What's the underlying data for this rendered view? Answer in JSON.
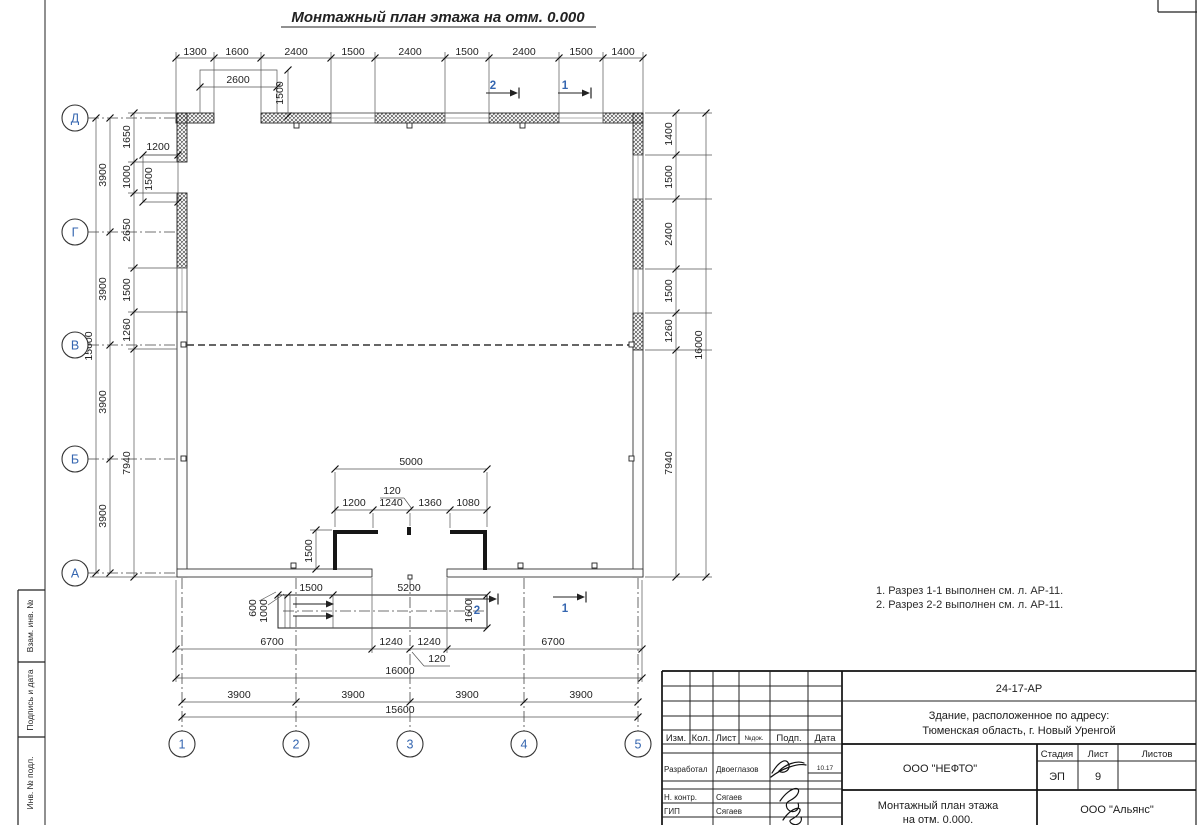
{
  "colors": {
    "axis_blue": "#3566b0",
    "ink": "#222222",
    "paper": "#ffffff"
  },
  "drawing": {
    "title": "Монтажный план этажа на отм. 0.000",
    "notes": {
      "line1": "1. Разрез 1-1 выполнен см. л. АР-11.",
      "line2": "2. Разрез 2-2 выполнен см. л. АР-11."
    }
  },
  "axis_bubbles": {
    "rows": [
      {
        "label": "Д",
        "cy": 118
      },
      {
        "label": "Г",
        "cy": 232
      },
      {
        "label": "В",
        "cy": 345
      },
      {
        "label": "Б",
        "cy": 459
      },
      {
        "label": "А",
        "cy": 573
      }
    ],
    "cols": [
      {
        "label": "1",
        "cx": 182
      },
      {
        "label": "2",
        "cx": 296
      },
      {
        "label": "3",
        "cx": 410
      },
      {
        "label": "4",
        "cx": 524
      },
      {
        "label": "5",
        "cx": 638
      }
    ]
  },
  "dimension_labels": [
    {
      "t": "1300",
      "x": 195,
      "y": 55,
      "r": 0
    },
    {
      "t": "1600",
      "x": 237,
      "y": 55,
      "r": 0
    },
    {
      "t": "2400",
      "x": 296,
      "y": 55,
      "r": 0
    },
    {
      "t": "1500",
      "x": 353,
      "y": 55,
      "r": 0
    },
    {
      "t": "2400",
      "x": 410,
      "y": 55,
      "r": 0
    },
    {
      "t": "1500",
      "x": 467,
      "y": 55,
      "r": 0
    },
    {
      "t": "2400",
      "x": 524,
      "y": 55,
      "r": 0
    },
    {
      "t": "1500",
      "x": 581,
      "y": 55,
      "r": 0
    },
    {
      "t": "1400",
      "x": 623,
      "y": 55,
      "r": 0
    },
    {
      "t": "2600",
      "x": 238,
      "y": 83,
      "r": 0
    },
    {
      "t": "1500",
      "x": 283,
      "y": 93,
      "r": 1
    },
    {
      "t": "1200",
      "x": 158,
      "y": 150,
      "r": 0
    },
    {
      "t": "1500",
      "x": 152,
      "y": 179,
      "r": 1
    },
    {
      "t": "1650",
      "x": 130,
      "y": 137,
      "r": 1
    },
    {
      "t": "1000",
      "x": 130,
      "y": 177,
      "r": 1
    },
    {
      "t": "2650",
      "x": 130,
      "y": 230,
      "r": 1
    },
    {
      "t": "1500",
      "x": 130,
      "y": 290,
      "r": 1
    },
    {
      "t": "1260",
      "x": 130,
      "y": 330,
      "r": 1
    },
    {
      "t": "7940",
      "x": 130,
      "y": 463,
      "r": 1
    },
    {
      "t": "3900",
      "x": 106,
      "y": 175,
      "r": 1
    },
    {
      "t": "3900",
      "x": 106,
      "y": 289,
      "r": 1
    },
    {
      "t": "3900",
      "x": 106,
      "y": 402,
      "r": 1
    },
    {
      "t": "3900",
      "x": 106,
      "y": 516,
      "r": 1
    },
    {
      "t": "15600",
      "x": 92,
      "y": 346,
      "r": 1
    },
    {
      "t": "1400",
      "x": 672,
      "y": 134,
      "r": 1
    },
    {
      "t": "1500",
      "x": 672,
      "y": 177,
      "r": 1
    },
    {
      "t": "2400",
      "x": 672,
      "y": 234,
      "r": 1
    },
    {
      "t": "1500",
      "x": 672,
      "y": 291,
      "r": 1
    },
    {
      "t": "1260",
      "x": 672,
      "y": 331,
      "r": 1
    },
    {
      "t": "7940",
      "x": 672,
      "y": 463,
      "r": 1
    },
    {
      "t": "16000",
      "x": 702,
      "y": 345,
      "r": 1
    },
    {
      "t": "5000",
      "x": 411,
      "y": 465,
      "r": 0
    },
    {
      "t": "120",
      "x": 392,
      "y": 494,
      "r": 0
    },
    {
      "t": "1200",
      "x": 354,
      "y": 506,
      "r": 0
    },
    {
      "t": "1240",
      "x": 391,
      "y": 506,
      "r": 0
    },
    {
      "t": "1360",
      "x": 430,
      "y": 506,
      "r": 0
    },
    {
      "t": "1080",
      "x": 468,
      "y": 506,
      "r": 0
    },
    {
      "t": "1500",
      "x": 312,
      "y": 551,
      "r": 1
    },
    {
      "t": "1500",
      "x": 311,
      "y": 591,
      "r": 0
    },
    {
      "t": "5200",
      "x": 409,
      "y": 591,
      "r": 0
    },
    {
      "t": "600",
      "x": 256,
      "y": 608,
      "r": 1
    },
    {
      "t": "1000",
      "x": 267,
      "y": 611,
      "r": 1
    },
    {
      "t": "1600",
      "x": 472,
      "y": 611,
      "r": 1
    },
    {
      "t": "6700",
      "x": 272,
      "y": 645,
      "r": 0
    },
    {
      "t": "1240",
      "x": 391,
      "y": 645,
      "r": 0
    },
    {
      "t": "1240",
      "x": 429,
      "y": 645,
      "r": 0
    },
    {
      "t": "120",
      "x": 437,
      "y": 662,
      "r": 0
    },
    {
      "t": "6700",
      "x": 553,
      "y": 645,
      "r": 0
    },
    {
      "t": "16000",
      "x": 400,
      "y": 674,
      "r": 0
    },
    {
      "t": "3900",
      "x": 239,
      "y": 698,
      "r": 0
    },
    {
      "t": "3900",
      "x": 353,
      "y": 698,
      "r": 0
    },
    {
      "t": "3900",
      "x": 467,
      "y": 698,
      "r": 0
    },
    {
      "t": "3900",
      "x": 581,
      "y": 698,
      "r": 0
    },
    {
      "t": "15600",
      "x": 400,
      "y": 713,
      "r": 0
    }
  ],
  "section_markers": [
    {
      "label": "2",
      "tx": 493,
      "ty": 89,
      "x1": 486,
      "y1": 93,
      "x2": 510
    },
    {
      "label": "1",
      "tx": 565,
      "ty": 89,
      "x1": 558,
      "y1": 93,
      "x2": 582
    },
    {
      "label": "2",
      "tx": 477,
      "ty": 614,
      "x1": 465,
      "y1": 599,
      "x2": 489
    },
    {
      "label": "1",
      "tx": 565,
      "ty": 612,
      "x1": 553,
      "y1": 597,
      "x2": 577
    }
  ],
  "side_strip": {
    "box1": "Взам. инв. №",
    "box2": "Подпись и дата",
    "box3": "Инв. № подл."
  },
  "title_block": {
    "doc_number": "24-17-АР",
    "address_line1": "Здание, расположенное по адресу:",
    "address_line2": "Тюменская область, г. Новый Уренгой",
    "columns": {
      "izm": "Изм.",
      "kol": "Кол.",
      "list": "Лист",
      "ndok": "№док.",
      "podp": "Подп.",
      "data": "Дата"
    },
    "rows": {
      "developed_label": "Разработал",
      "developed_name": "Двоеглазов",
      "developed_date": "10.17",
      "ncontr_label": "Н. контр.",
      "ncontr_name": "Сягаев",
      "gip_label": "ГИП",
      "gip_name": "Сягаев"
    },
    "company": "ООО \"НЕФТО\"",
    "stage_label": "Стадия",
    "sheet_label": "Лист",
    "sheets_label": "Листов",
    "stage_value": "ЭП",
    "sheet_value": "9",
    "sheets_value": "",
    "drawing_name_line1": "Монтажный план этажа",
    "drawing_name_line2": "на отм. 0.000.",
    "contractor": "ООО \"Альянс\""
  }
}
